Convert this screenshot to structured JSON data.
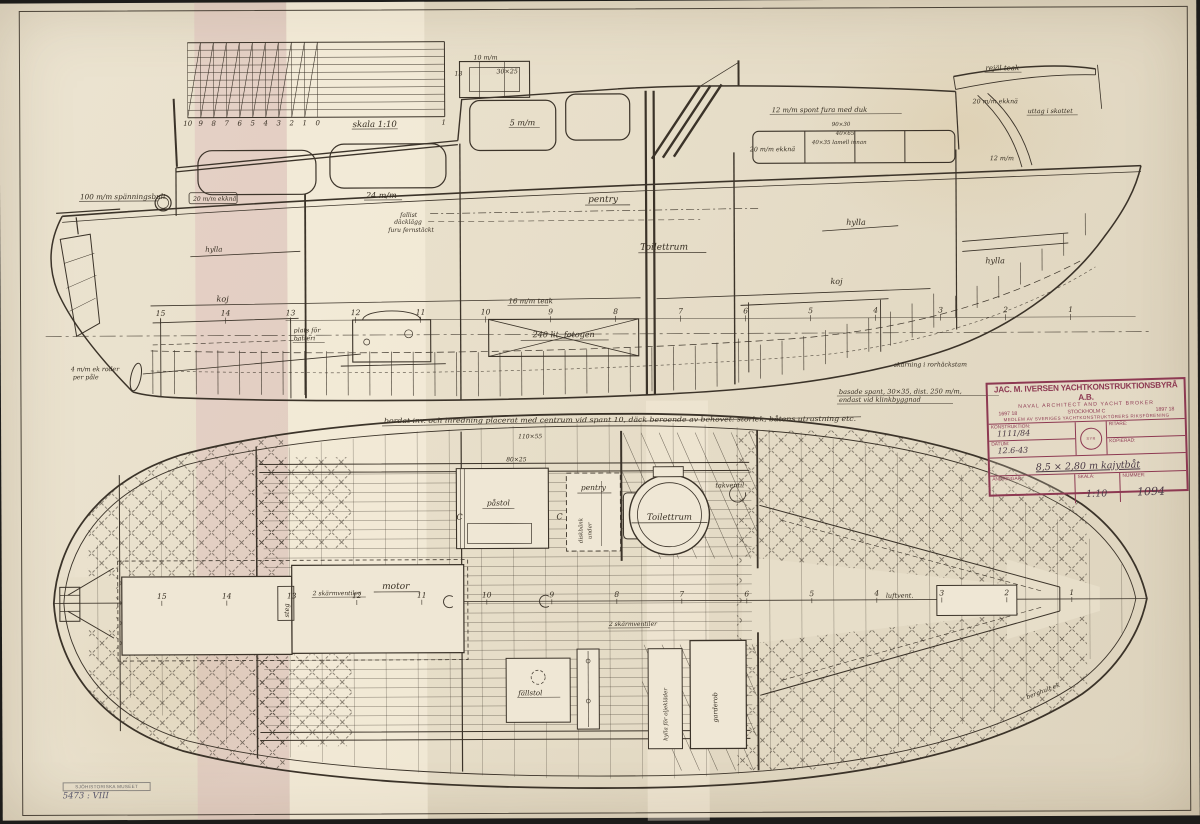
{
  "colors": {
    "paper": "#e7dec9",
    "ink": "#3b3329",
    "stamp": "#8d3952",
    "background": "#1d1c1a",
    "furniture_fill": "#efe7d5"
  },
  "scale_ruler": {
    "label": "skala 1:10",
    "numbers": [
      "10",
      "9",
      "8",
      "7",
      "6",
      "5",
      "4",
      "3",
      "2",
      "1",
      "0"
    ],
    "end_number": "1"
  },
  "stations": [
    "15",
    "14",
    "13",
    "12",
    "11",
    "10",
    "9",
    "8",
    "7",
    "6",
    "5",
    "4",
    "3",
    "2",
    "1"
  ],
  "profile_labels": {
    "spanningsbult": "100 m/m spänningsbult",
    "ekkna_boxed": "20 m/m ekknä",
    "planking24": "24 m/m",
    "fallist": "fallist",
    "dacklagg": "däcklägg",
    "fernstackt": "furu fernstäckt",
    "pentry": "pentry",
    "toilettrum": "Toilettrum",
    "hylla_aft": "hylla",
    "hylla_mid": "hylla",
    "hylla_fwd": "hylla",
    "koj_aft": "koj",
    "koj_fwd": "koj",
    "batteri1": "plats för",
    "batteri2": "batteri",
    "teak": "16 m/m teak",
    "tank": "240 lit. fotogen",
    "spant1": "basade spant, 30×35, dist. 250 m/m,",
    "spant2": "endast vid klinkbyggnad",
    "longnote": "bordat inv. och inredning placerat med centrum vid spant 10, däck beroende av behovet: storlek, båtens utrustning etc.",
    "w5": "5 m/m",
    "w10": "10 m/m",
    "w3025": "30×25",
    "w13": "13",
    "sponta": "12 m/m spont fura med duk",
    "d9030": "90×30",
    "d4065": "40×65",
    "d4035": "40×35 lamell innan",
    "ekkna_mid": "20 m/m ekknä",
    "rejal": "rejäl teak",
    "ekkna_bow": "20 m/m ekknä",
    "uttag": "uttag i skottet",
    "w12": "12 m/m",
    "roder": "4 m/m ek roder",
    "pale": "per påle",
    "skarning": "skärning i rorhäckstam"
  },
  "plan_labels": {
    "motor": "motor",
    "ventiler_aft": "2 skärmventiler",
    "steg": "steg",
    "pentry": "pentry",
    "diskbank": "diskbänk",
    "under": "under",
    "pastol": "påstol",
    "toilettrum": "Toilettrum",
    "takventil": "takventil",
    "fallstol": "fällstol",
    "ventiler_mid": "2 skärmventiler",
    "oljeklader": "hylla för oljekläder",
    "garderob": "garderob",
    "luftvent": "luftvent.",
    "dim11055": "110×55",
    "dim8025": "80×25",
    "berghult": "berghult ek",
    "section_c": "C"
  },
  "title_block": {
    "company": "JAC. M. IVERSEN YACHTKONSTRUKTIONSBYRÅ A.B.",
    "subtitle": "NAVAL ARCHITECT AND YACHT BROKER",
    "phone_left": "1697 18",
    "city": "STOCKHOLM C",
    "phone_right": "1897 18",
    "member_line": "MEDLEM AV SVERIGES YACHTKONSTRUKTÖRERS RIKSFÖRENING",
    "seal": "SYR",
    "fields": {
      "konstruktion_label": "KONSTRUKTION:",
      "konstruktion_value": "1111/84",
      "datum_label": "DATUM:",
      "datum_value": "12.6-43",
      "ritare_label": "RITARE:",
      "ritare_value": "",
      "kopierad_label": "KOPIERAD:",
      "kopierad_value": "",
      "description": "8,5 × 2,80 m kajytbåt",
      "andringar_label": "ÄNDRINGAR:",
      "skala_label": "SKALA:",
      "skala_value": "1:10",
      "nummer_label": "NUMMER:",
      "nummer_value": "1094"
    }
  },
  "museum_stamp": {
    "line1": "SJÖHISTORISKA MUSEET",
    "line2": "5473 : VIII"
  }
}
